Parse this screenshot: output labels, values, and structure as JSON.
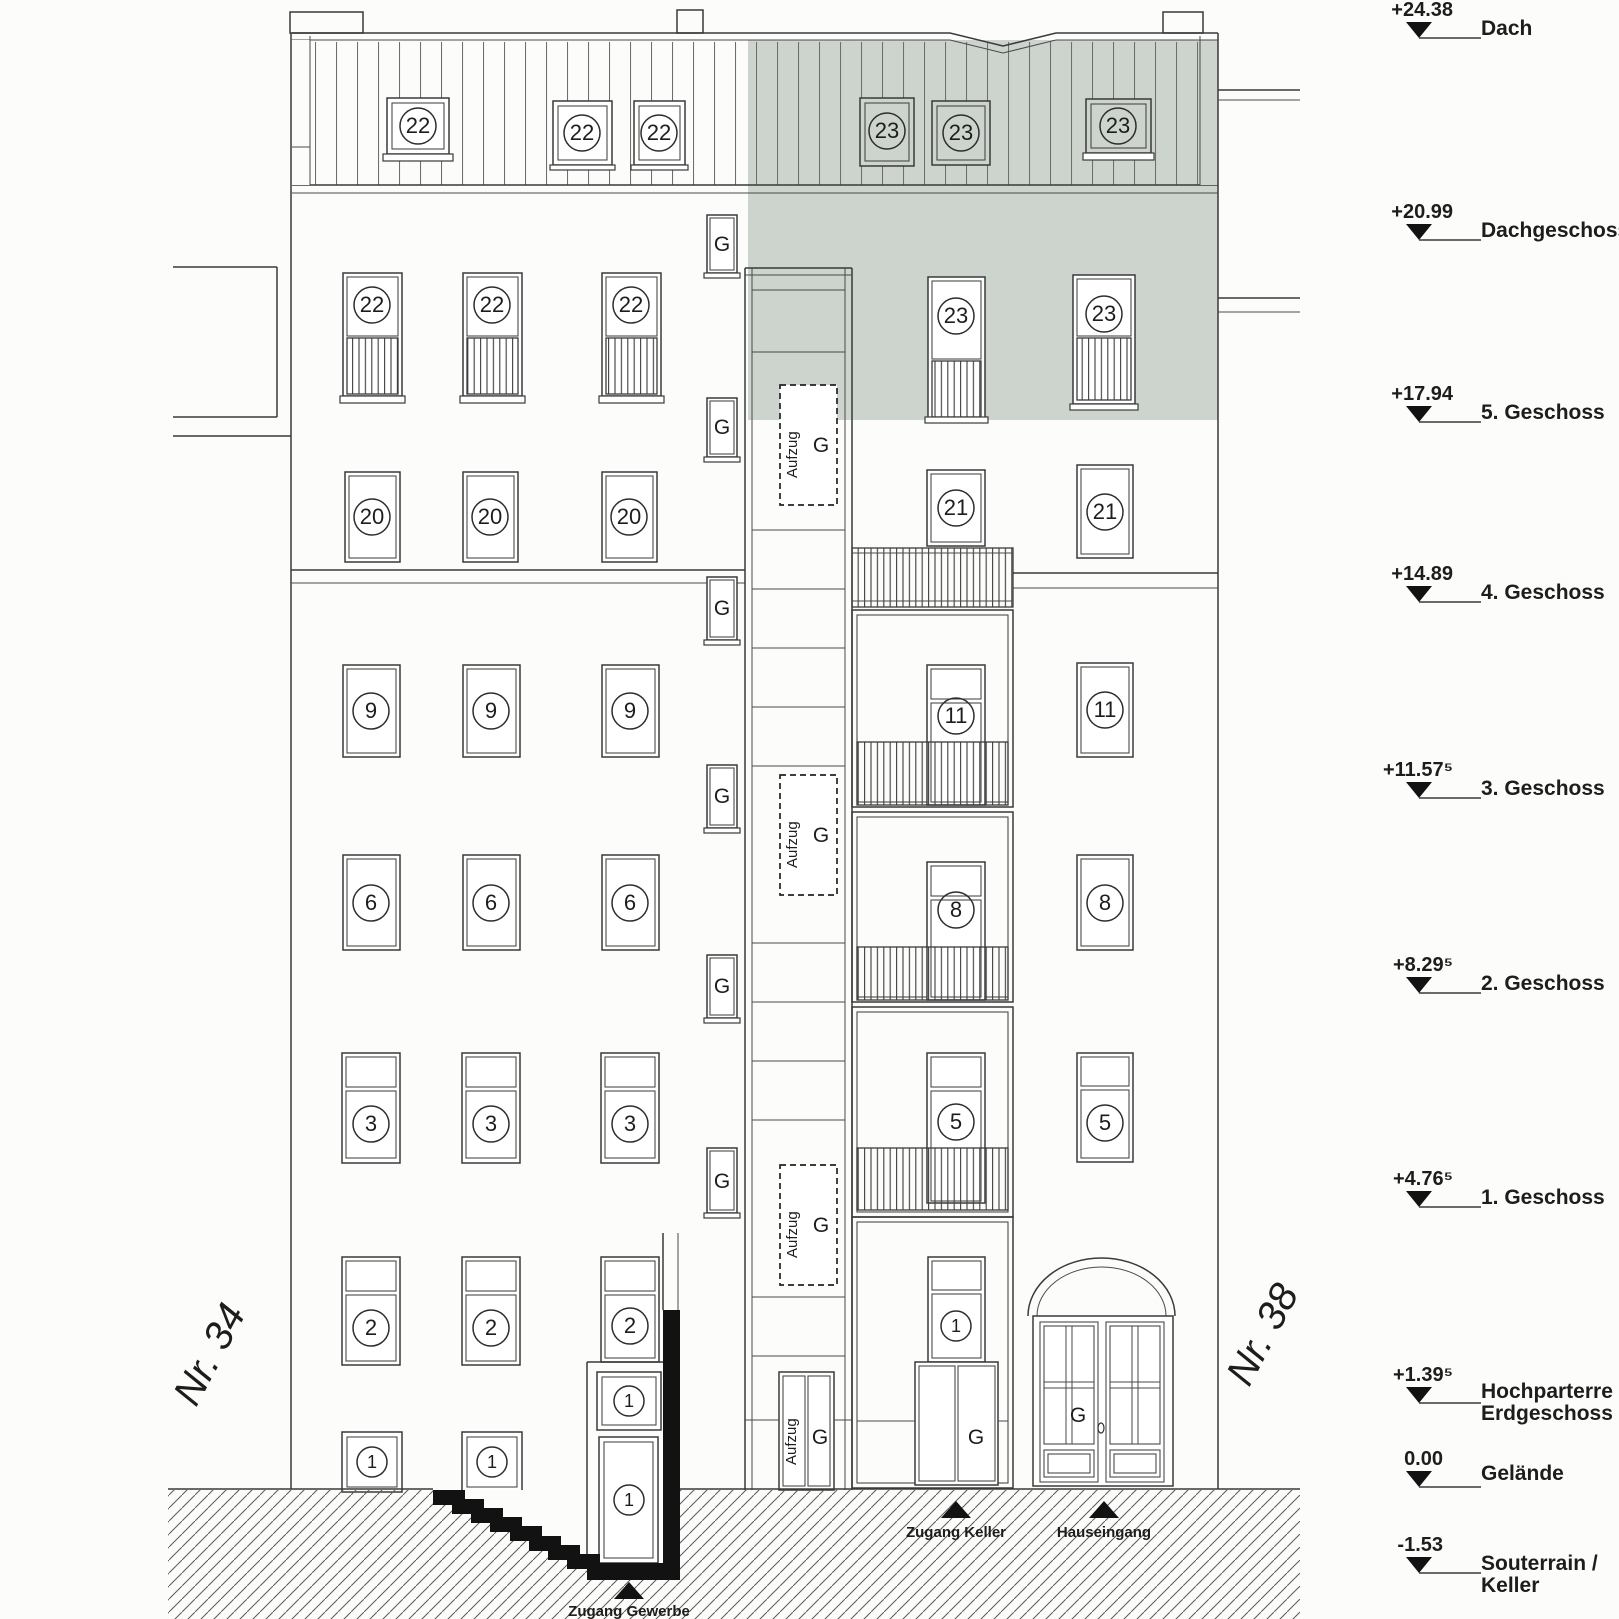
{
  "site": {
    "left_house": "Nr. 34",
    "right_house": "Nr. 38"
  },
  "labels": {
    "elevator": "Aufzug",
    "glyph_g": "G",
    "entry_commercial": "Zugang Gewerbe",
    "entry_cellar": "Zugang Keller",
    "entry_house": "Hauseingang"
  },
  "levels": [
    {
      "value": "+24.38",
      "label": "Dach",
      "label2": ""
    },
    {
      "value": "+20.99",
      "label": "Dachgeschoss",
      "label2": ""
    },
    {
      "value": "+17.94",
      "label": "5. Geschoss",
      "label2": ""
    },
    {
      "value": "+14.89",
      "label": "4. Geschoss",
      "label2": ""
    },
    {
      "value": "+11.57⁵",
      "label": "3. Geschoss",
      "label2": ""
    },
    {
      "value": "+8.29⁵",
      "label": "2. Geschoss",
      "label2": ""
    },
    {
      "value": "+4.76⁵",
      "label": "1. Geschoss",
      "label2": ""
    },
    {
      "value": "+1.39⁵",
      "label": "Hochparterre /",
      "label2": "Erdgeschoss"
    },
    {
      "value": "0.00",
      "label": "Gelände",
      "label2": ""
    },
    {
      "value": "-1.53",
      "label": "Souterrain /",
      "label2": "Keller"
    }
  ],
  "units": {
    "roof_left": [
      "22",
      "22",
      "22"
    ],
    "roof_right": [
      "23",
      "23",
      "23"
    ],
    "dg_left": [
      "22",
      "22",
      "22"
    ],
    "dg_right": [
      "23",
      "23"
    ],
    "f4_left": [
      "20",
      "20",
      "20"
    ],
    "f4_right": [
      "21",
      "21"
    ],
    "f3_left": [
      "9",
      "9",
      "9"
    ],
    "f3_right": [
      "11",
      "11"
    ],
    "f2_left": [
      "6",
      "6",
      "6"
    ],
    "f2_right": [
      "8",
      "8"
    ],
    "f1_left": [
      "3",
      "3",
      "3"
    ],
    "f1_right": [
      "5",
      "5"
    ],
    "hp_left": [
      "2",
      "2",
      "2"
    ],
    "hp_right": [
      "1"
    ],
    "base_left": [
      "1",
      "1"
    ],
    "commercial": [
      "1",
      "1"
    ],
    "cellar_window": "1"
  },
  "colors": {
    "highlight": "#ccd4cd",
    "line": "#3a3a3a",
    "paper": "#fcfcfa",
    "cut": "#121212"
  }
}
